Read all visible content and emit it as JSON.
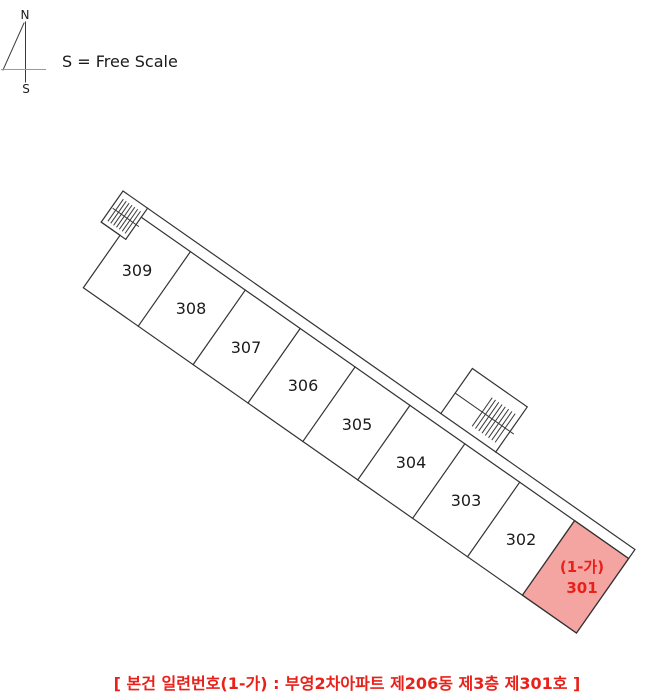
{
  "compass": {
    "north": "N",
    "south": "S",
    "scale_note": "S = Free Scale"
  },
  "plan": {
    "units": [
      {
        "label": "309"
      },
      {
        "label": "308"
      },
      {
        "label": "307"
      },
      {
        "label": "306"
      },
      {
        "label": "305"
      },
      {
        "label": "304"
      },
      {
        "label": "303"
      },
      {
        "label": "302"
      }
    ],
    "highlight_unit": {
      "tag": "(1-가)",
      "label": "301"
    }
  },
  "caption": {
    "text": "[ 본건 일련번호(1-가) : 부영2차아파트 제206동 제3층 제301호 ]"
  },
  "colors": {
    "line": "#333333",
    "highlight_fill": "#F4A5A2",
    "highlight_text": "#E8211A",
    "caption_text": "#E8211A"
  }
}
